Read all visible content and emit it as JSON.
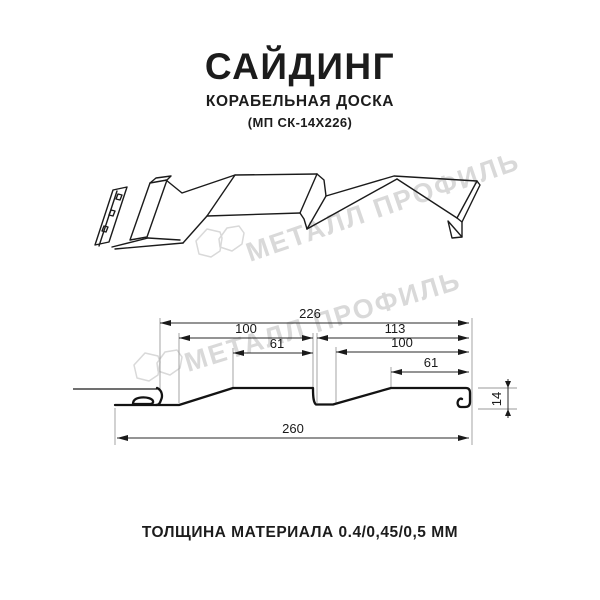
{
  "header": {
    "title": "САЙДИНГ",
    "subtitle": "КОРАБЕЛЬНАЯ ДОСКА",
    "model": "(МП СК-14Х226)"
  },
  "footer": {
    "text": "ТОЛЩИНА МАТЕРИАЛА 0.4/0,45/0,5 ММ"
  },
  "watermark": {
    "text": "МЕТАЛЛ ПРОФИЛЬ",
    "color": "#d9d9d9",
    "logo": "metal-profil-logo"
  },
  "colors": {
    "line": "#1b1b1b",
    "background": "#ffffff"
  },
  "dimensions": {
    "overall_cover_width": "226",
    "left_wave_width": "100",
    "left_flat_width": "61",
    "right_section_width": "113",
    "right_wave_width": "100",
    "right_flat_width": "61",
    "total_width": "260",
    "profile_depth": "14"
  }
}
